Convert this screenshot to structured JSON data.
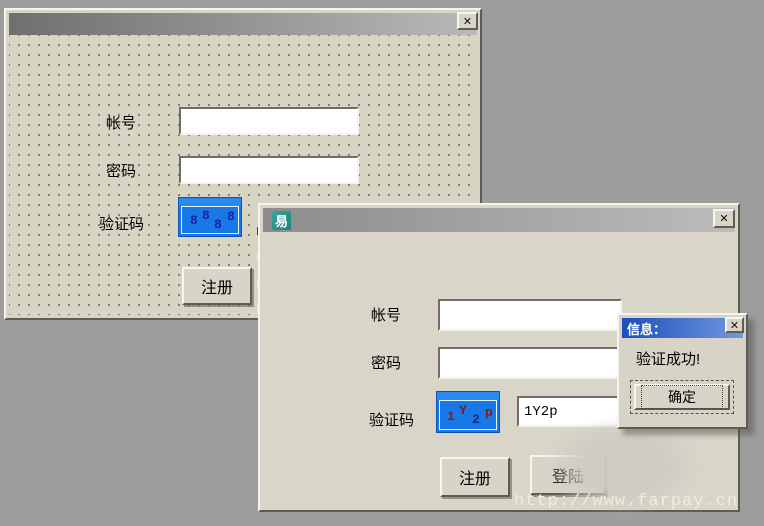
{
  "desktop": {
    "background_color": "#9d9d9d"
  },
  "back_window": {
    "close_icon": "✕",
    "account_label": "帐号",
    "password_label": "密码",
    "captcha_label": "验证码",
    "captcha_chars": [
      {
        "ch": "8",
        "color": "#18259c"
      },
      {
        "ch": "8",
        "color": "#18259c"
      },
      {
        "ch": "8",
        "color": "#18259c"
      },
      {
        "ch": "8",
        "color": "#18259c"
      }
    ],
    "captcha_bg": "#1878e8",
    "register_button": "注册"
  },
  "front_window": {
    "app_icon_char": "易",
    "app_icon_color": "#2a9a92",
    "close_icon": "✕",
    "account_label": "帐号",
    "password_label": "密码",
    "captcha_label": "验证码",
    "captcha_chars": [
      {
        "ch": "1",
        "color": "#8b1e14"
      },
      {
        "ch": "Y",
        "color": "#7a1a10"
      },
      {
        "ch": "2",
        "color": "#1a2a8e"
      },
      {
        "ch": "p",
        "color": "#8b1e14"
      }
    ],
    "captcha_bg": "#1878e8",
    "captcha_input_value": "1Y2p",
    "register_button": "注册",
    "login_button": "登陆"
  },
  "dialog": {
    "title": "信息：",
    "title_bar_color": "#1e4fb8",
    "close_icon": "✕",
    "message": "验证成功!",
    "ok_button": "确定"
  },
  "watermark": {
    "text": "http://www.farpay.cn",
    "color": "#f2edda"
  }
}
